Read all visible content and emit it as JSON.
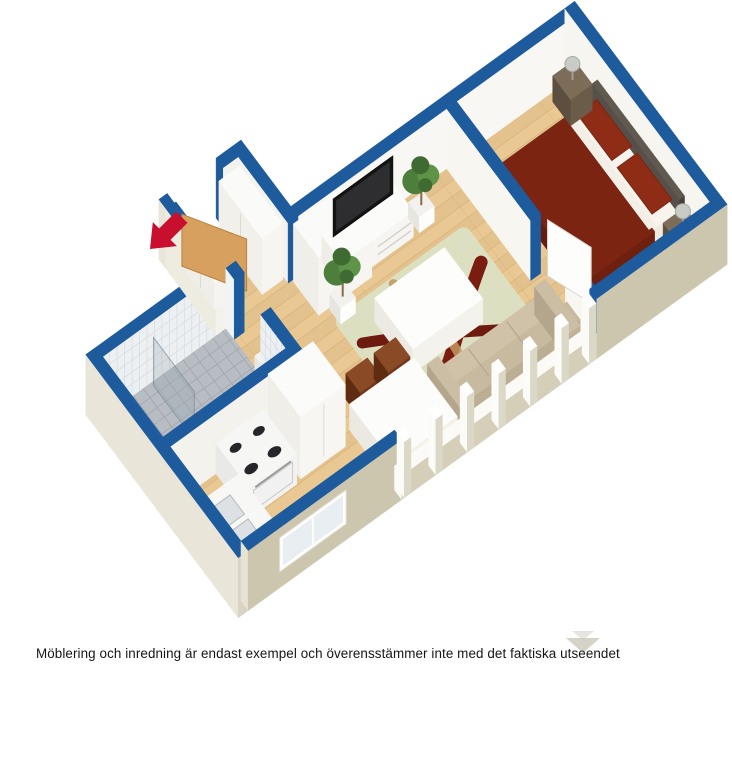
{
  "caption": "Möblering och inredning är endast exempel och överensstämmer inte med det faktiska utseendet",
  "scene": {
    "type": "isometric-3d-floorplan",
    "entrance_marker": "red-arrow",
    "rooms": [
      {
        "name": "hall",
        "features": [
          "entrance-door-open",
          "wardrobe",
          "sideboard"
        ]
      },
      {
        "name": "bathroom",
        "features": [
          "gray-tile-floor",
          "white-tile-walls",
          "toilet",
          "shower-glass"
        ]
      },
      {
        "name": "kitchen",
        "features": [
          "stove-with-oven",
          "double-sink-counter",
          "tall-cabinet",
          "window"
        ]
      },
      {
        "name": "dining-area",
        "features": [
          "white-table",
          "brown-chairs"
        ]
      },
      {
        "name": "living-room",
        "features": [
          "tv-bench",
          "flat-tv",
          "potted-plant",
          "potted-plant",
          "coffee-table",
          "rug",
          "sofa",
          "low-window-wall"
        ]
      },
      {
        "name": "bedroom",
        "features": [
          "double-bed",
          "nightstand",
          "nightstand",
          "lamp",
          "lamp",
          "open-door"
        ]
      }
    ]
  },
  "colors": {
    "background": "#ffffff",
    "wall_top_blue": "#1d5b9d",
    "wall_white": "#f8f7f3",
    "wall_white_shade": "#eceae3",
    "exterior_beige": "#cdc6ae",
    "exterior_light": "#e9e5d8",
    "floor_wood": "#e9c893",
    "floor_seam": "#c9a76b",
    "bath_floor": "#b8bdc3",
    "bath_grid": "#a2a7ad",
    "tile_face": "#edf0f2",
    "tile_line": "#d7dbde",
    "rug_base": "#dce0c4",
    "rug_dark": "#7a1d10",
    "rug_tan": "#c1985f",
    "sofa": "#c6b89e",
    "sofa_dark": "#b3a68c",
    "bed_spread": "#7c2412",
    "bed_spread_dark": "#671d0d",
    "bed_pillow": "#8f2c15",
    "bed_sheet": "#f3efe6",
    "headboard": "#57504a",
    "nightstand": "#6b5b49",
    "chair": "#8a4a26",
    "chair_dark": "#5f2c12",
    "plant": "#4e7e3c",
    "plant_dark": "#3f6a31",
    "plant_light": "#5f9348",
    "pot_white": "#fdfdfc",
    "tv_black": "#141414",
    "door_tan": "#d7a05e",
    "door_tan_edge": "#b9813f",
    "door_white": "#fdfdfc",
    "arrow_red": "#c8102e",
    "caption_text": "#151515",
    "chevron_gray": "#c7c3b6",
    "window_frame": "#fbfaf6",
    "sill_beige": "#d5cfba"
  }
}
